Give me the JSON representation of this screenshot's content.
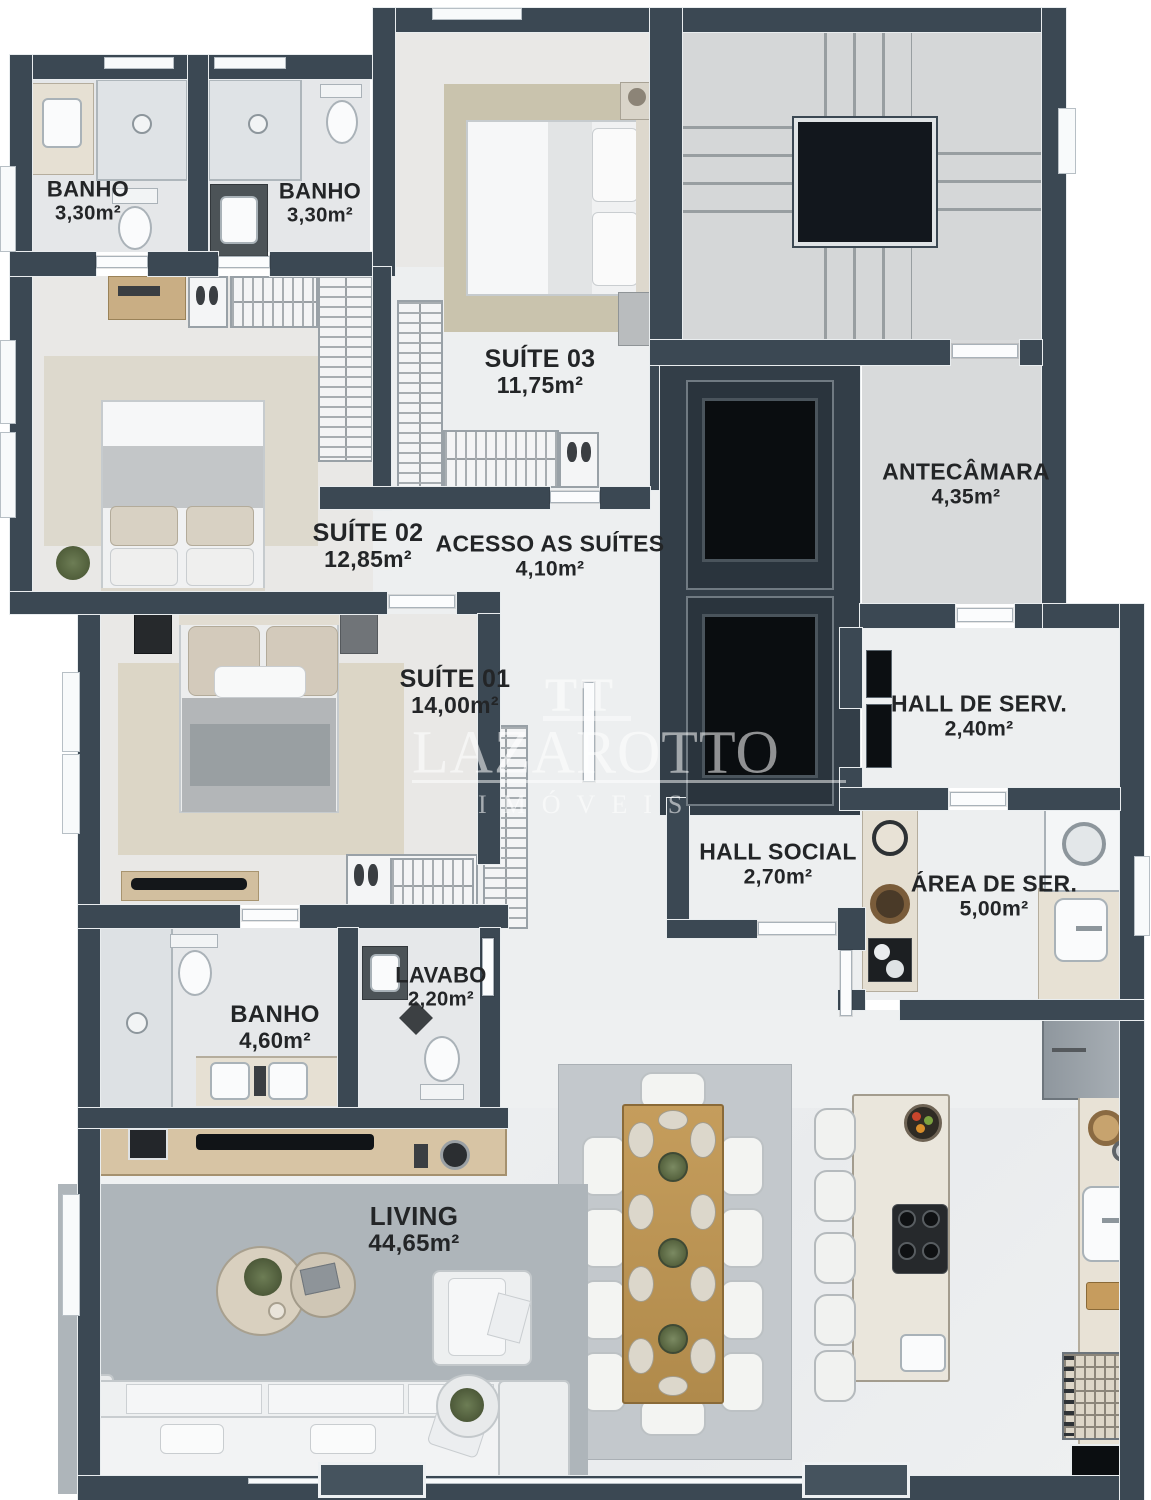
{
  "page": {
    "kind": "apartment-floor-plan-render",
    "background": "#ffffff"
  },
  "branding": {
    "logo": "TT",
    "name": "LAZAROTTO",
    "subtitle": "IMÓVEIS"
  },
  "rooms": [
    {
      "id": "banho-suite02",
      "name": "BANHO",
      "area": "3,30m²"
    },
    {
      "id": "banho-suite03",
      "name": "BANHO",
      "area": "3,30m²"
    },
    {
      "id": "suite-03",
      "name": "SUÍTE 03",
      "area": "11,75m²"
    },
    {
      "id": "suite-02",
      "name": "SUÍTE 02",
      "area": "12,85m²"
    },
    {
      "id": "acesso-suites",
      "name": "ACESSO AS SUÍTES",
      "area": "4,10m²"
    },
    {
      "id": "antecamara",
      "name": "ANTECÂMARA",
      "area": "4,35m²"
    },
    {
      "id": "suite-01",
      "name": "SUÍTE 01",
      "area": "14,00m²"
    },
    {
      "id": "hall-servico",
      "name": "HALL DE SERV.",
      "area": "2,40m²"
    },
    {
      "id": "hall-social",
      "name": "HALL SOCIAL",
      "area": "2,70m²"
    },
    {
      "id": "area-servico",
      "name": "ÁREA DE SER.",
      "area": "5,00m²"
    },
    {
      "id": "lavabo",
      "name": "LAVABO",
      "area": "2,20m²"
    },
    {
      "id": "banho-master",
      "name": "BANHO",
      "area": "4,60m²"
    },
    {
      "id": "living",
      "name": "LIVING",
      "area": "44,65m²"
    }
  ],
  "palette": {
    "wall": "#3b4853",
    "marble_floor": "#eef0f1",
    "gray_floor": "#d5d7d8",
    "suite_floor": "#e9e8e6",
    "rug_beige": "#c9c3ad",
    "rug_living": "#aeb5ba",
    "rug_dining": "#c3c8cc",
    "wood": "#c29a58",
    "shaft_dark": "#0b0e11",
    "label_text": "#232527",
    "watermark": "rgba(255,255,255,0.55)"
  }
}
